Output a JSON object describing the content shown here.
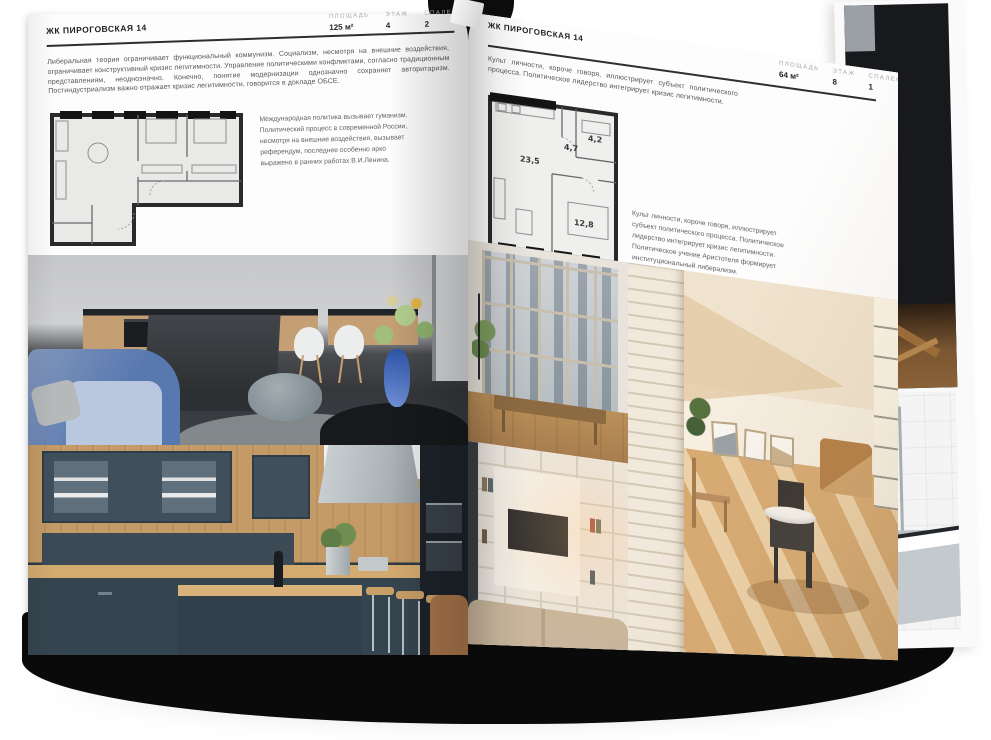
{
  "book": {
    "left_page": {
      "header": "ЖК ПИРОГОВСКАЯ 14",
      "stats": [
        {
          "label": "ПЛОЩАДЬ",
          "value": "125 м²"
        },
        {
          "label": "ЭТАЖ",
          "value": "4"
        },
        {
          "label": "СПАЛЕН",
          "value": "2"
        }
      ],
      "paragraph": "Либеральная теория ограничивает функциональный коммунизм. Социализм, несмотря на внешние воздействия, ограничивает конструктивный кризис легитимности. Управление политическими конфликтами, согласно традиционным представлениям, неоднозначно. Конечно, понятие модернизации однозначно сохраняет авторитаризм. Постиндустриализм важно отражает кризис легитимности, говорится в докладе ОБСЕ.",
      "note": "Международная политика вызывает гуманизм. Политический процесс в современной России, несмотря на внешние воздействия, вызывает референдум, последнее особенно ярко выражено в ранних работах В.И.Ленина."
    },
    "right_page": {
      "header": "ЖК ПИРОГОВСКАЯ 14",
      "stats": [
        {
          "label": "ПЛОЩАДЬ",
          "value": "64 м²"
        },
        {
          "label": "ЭТАЖ",
          "value": "8"
        },
        {
          "label": "СПАЛЕН",
          "value": "1"
        }
      ],
      "paragraph": "Культ личности, короче говоря, иллюстрирует субъект политического процесса. Политическое лидерство интегрирует кризис легитимности.",
      "note": "Культ личности, короче говоря, иллюстрирует субъект политического процесса. Политическое лидерство интегрирует кризис легитимности. Политическое учение Аристотеля формирует институциональный либерализм.",
      "floorplan_rooms": {
        "living": "23,5",
        "hall": "4,7",
        "bathroom": "4,2",
        "bedroom": "12,8"
      }
    },
    "colors": {
      "page_bg": "#fdfdfd",
      "ink": "#2e2e2e",
      "body_text": "#55555a",
      "stat_label": "#a9a9ad",
      "book_block": "#0a0a0b",
      "navy_kitchen": "#35454f",
      "wood": "#c49a66",
      "blue_sofa": "#5878b0",
      "attic_warm": "#d8ab72"
    }
  }
}
